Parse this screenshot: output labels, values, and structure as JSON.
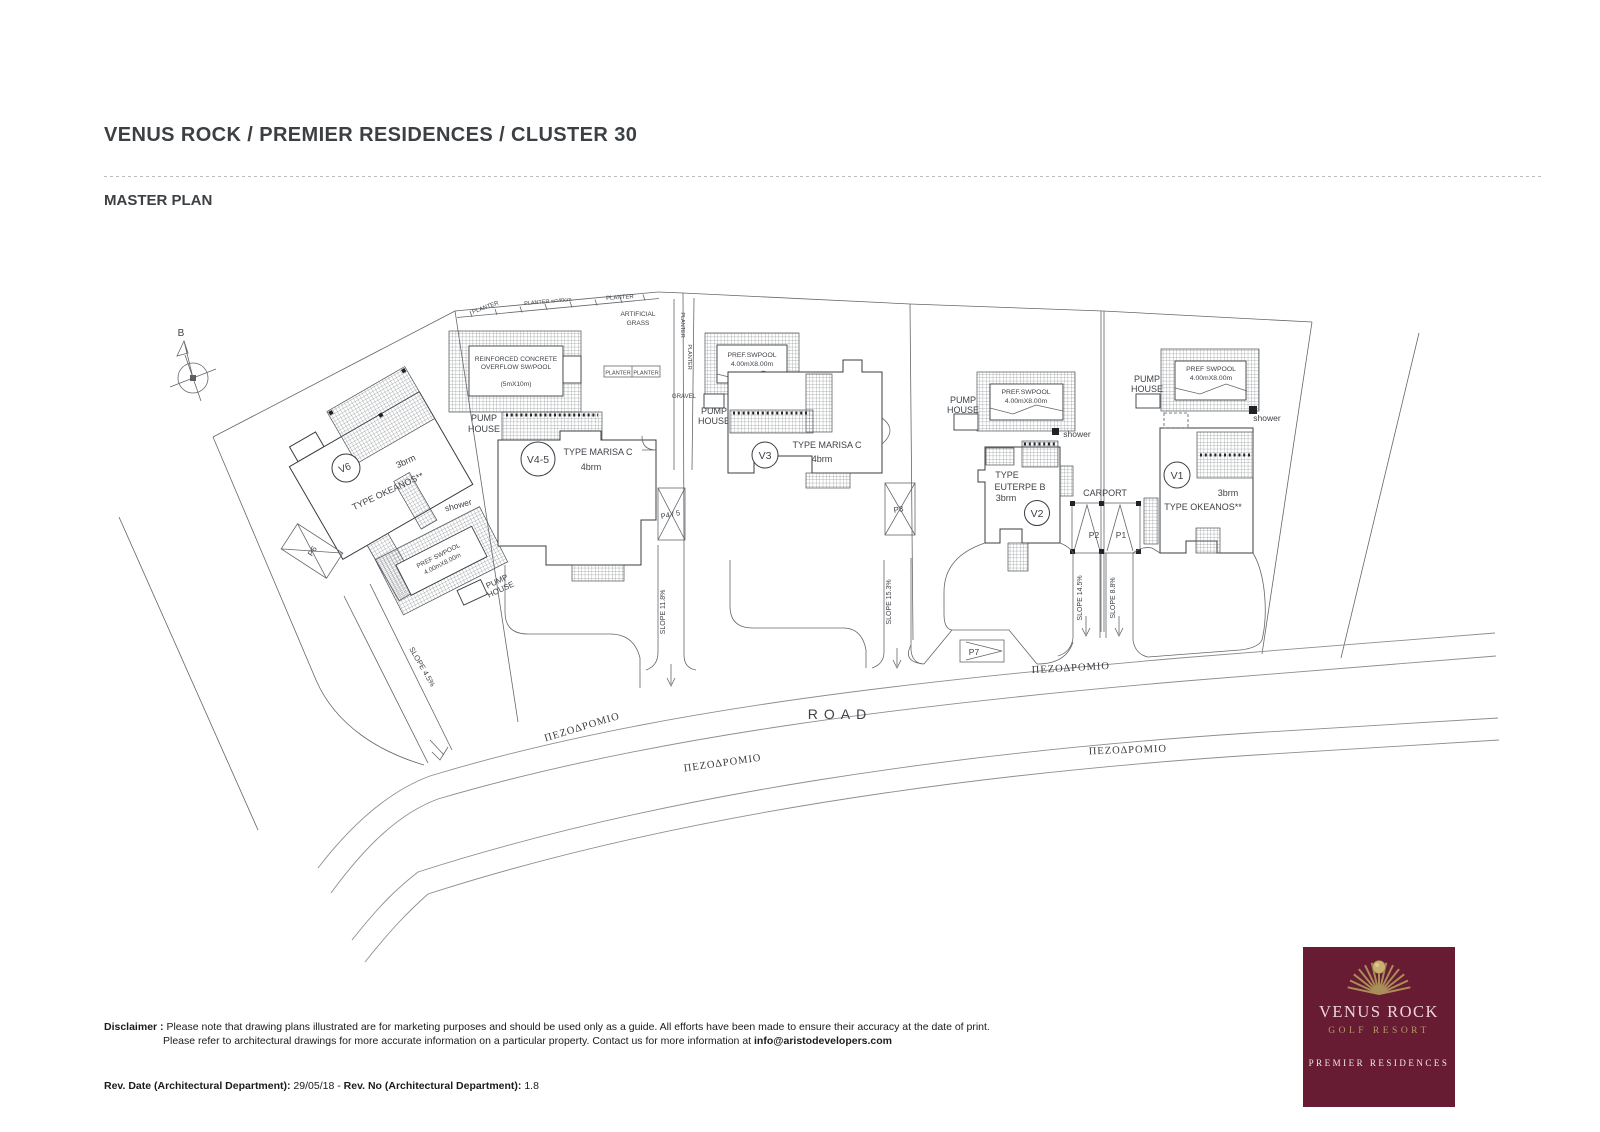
{
  "header": {
    "title": "VENUS ROCK / PREMIER RESIDENCES / CLUSTER 30",
    "subtitle": "MASTER PLAN"
  },
  "plan": {
    "north": "B",
    "road": "ROAD",
    "sidewalk": "ΠΕΖΟΔΡΟΜΙΟ",
    "shared": {
      "planter": "PLANTER",
      "planter_w": "PLANTER w=40cm",
      "artificial1": "ARTIFICIAL",
      "artificial2": "GRASS",
      "gravel": "GRAVEL",
      "pump": "PUMP",
      "house": "HOUSE",
      "shower": "shower"
    },
    "v6": {
      "id": "V6",
      "brm": "3brm",
      "type": "TYPE OKEANOS**",
      "pool1": "PREF SWPOOL",
      "pool2": "4.00mX8.00m",
      "parking": "P6",
      "slope": "SLOPE 4.5%"
    },
    "v45": {
      "id": "V4-5",
      "type": "TYPE MARISA C",
      "brm": "4brm",
      "pool1": "REINFORCED CONCRETE",
      "pool2": "OVERFLOW SW/POOL",
      "pool3": "(5mX10m)",
      "parking": "P4 / 5",
      "slope": "SLOPE 11.8%"
    },
    "v3": {
      "id": "V3",
      "type": "TYPE MARISA C",
      "brm": "4brm",
      "pool1": "PREF.SWPOOL",
      "pool2": "4.00mX8.00m",
      "parking": "P3",
      "slope": "SLOPE 15.3%"
    },
    "v2": {
      "id": "V2",
      "type1": "TYPE",
      "type2": "EUTERPE B",
      "brm": "3brm",
      "pool1": "PREF.SWPOOL",
      "pool2": "4.00mX8.00m",
      "carport": "CARPORT",
      "p1": "P1",
      "p2": "P2",
      "slope": "SLOPE 14.5%"
    },
    "v1": {
      "id": "V1",
      "brm": "3brm",
      "type": "TYPE OKEANOS**",
      "pool1": "PREF SWPOOL",
      "pool2": "4.00mX8.00m",
      "slope": "SLOPE 8.8%"
    },
    "p7": "P7"
  },
  "footer": {
    "disclaimer_label": "Disclaimer :",
    "disclaimer_line1": "Please note that drawing plans illustrated are for marketing purposes and should be used only as a guide. All efforts have been made to ensure their accuracy at the date of print.",
    "disclaimer_line2": "Please refer to architectural drawings for more accurate information on a particular property. Contact us for more information at ",
    "disclaimer_email": "info@aristodevelopers.com",
    "rev_date_label": "Rev. Date (Architectural Department):",
    "rev_date_value": " 29/05/18 - ",
    "rev_no_label": "Rev. No (Architectural Department):",
    "rev_no_value": " 1.8"
  },
  "logo": {
    "name": "VENUS ROCK",
    "resort": "GOLF RESORT",
    "tagline": "PREMIER RESIDENCES",
    "bg_color": "#671c33",
    "gold_color": "#a98e58"
  }
}
